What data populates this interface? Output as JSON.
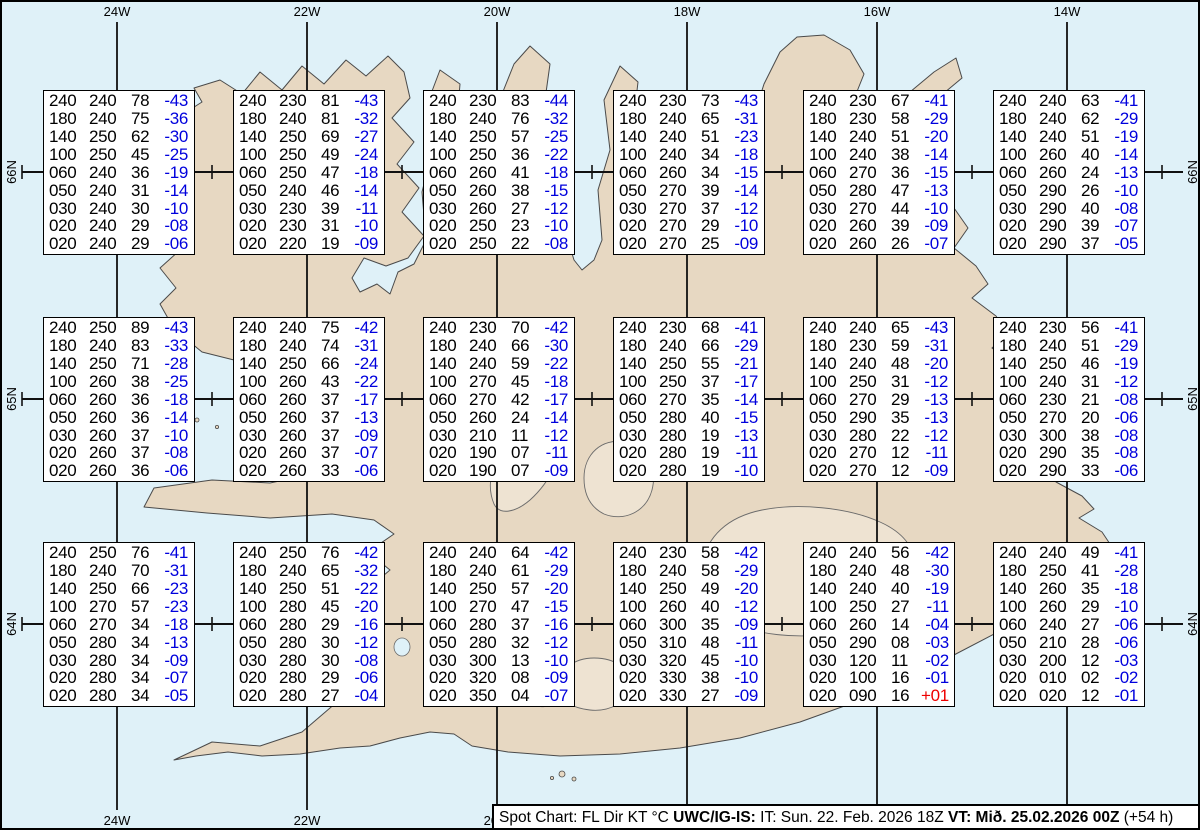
{
  "status_bar": {
    "prefix": "Spot Chart: FL Dir KT °C ",
    "source": "UWC/IG-IS:",
    "issued": " IT: Sun. 22. Feb. 2026 18Z ",
    "valid": "VT: Mið. 25.02.2026 00Z",
    "offset": " (+54 h)"
  },
  "grid": {
    "lon_labels_top": [
      "24W",
      "22W",
      "20W",
      "18W",
      "16W",
      "14W"
    ],
    "lon_labels_bottom": [
      "24W",
      "22W",
      "20W"
    ],
    "lat_labels_left": [
      "66N",
      "65N",
      "64N"
    ],
    "lat_labels_right": [
      "66N",
      "65N",
      "64N"
    ]
  },
  "colors": {
    "water": "#dff1f8",
    "land": "#e7d8c2",
    "coastline": "#4a4a4a",
    "grid_line": "#111111",
    "temp_blue": "#0000dd",
    "temp_red": "#ee0000"
  },
  "columns_meaning": [
    "FL",
    "Dir",
    "KT",
    "°C"
  ],
  "spots": [
    {
      "rows": [
        [
          "240",
          "240",
          "78",
          "-43"
        ],
        [
          "180",
          "240",
          "75",
          "-36"
        ],
        [
          "140",
          "250",
          "62",
          "-30"
        ],
        [
          "100",
          "250",
          "45",
          "-25"
        ],
        [
          "060",
          "240",
          "36",
          "-19"
        ],
        [
          "050",
          "240",
          "31",
          "-14"
        ],
        [
          "030",
          "240",
          "30",
          "-10"
        ],
        [
          "020",
          "240",
          "29",
          "-08"
        ],
        [
          "020",
          "240",
          "29",
          "-06"
        ]
      ]
    },
    {
      "rows": [
        [
          "240",
          "230",
          "81",
          "-43"
        ],
        [
          "180",
          "240",
          "81",
          "-32"
        ],
        [
          "140",
          "250",
          "69",
          "-27"
        ],
        [
          "100",
          "250",
          "49",
          "-24"
        ],
        [
          "060",
          "250",
          "47",
          "-18"
        ],
        [
          "050",
          "240",
          "46",
          "-14"
        ],
        [
          "030",
          "230",
          "39",
          "-11"
        ],
        [
          "020",
          "230",
          "31",
          "-10"
        ],
        [
          "020",
          "220",
          "19",
          "-09"
        ]
      ]
    },
    {
      "rows": [
        [
          "240",
          "230",
          "83",
          "-44"
        ],
        [
          "180",
          "240",
          "76",
          "-32"
        ],
        [
          "140",
          "250",
          "57",
          "-25"
        ],
        [
          "100",
          "250",
          "36",
          "-22"
        ],
        [
          "060",
          "260",
          "41",
          "-18"
        ],
        [
          "050",
          "260",
          "38",
          "-15"
        ],
        [
          "030",
          "260",
          "27",
          "-12"
        ],
        [
          "020",
          "250",
          "23",
          "-10"
        ],
        [
          "020",
          "250",
          "22",
          "-08"
        ]
      ]
    },
    {
      "rows": [
        [
          "240",
          "230",
          "73",
          "-43"
        ],
        [
          "180",
          "240",
          "65",
          "-31"
        ],
        [
          "140",
          "240",
          "51",
          "-23"
        ],
        [
          "100",
          "240",
          "34",
          "-18"
        ],
        [
          "060",
          "260",
          "34",
          "-15"
        ],
        [
          "050",
          "270",
          "39",
          "-14"
        ],
        [
          "030",
          "270",
          "37",
          "-12"
        ],
        [
          "020",
          "270",
          "29",
          "-10"
        ],
        [
          "020",
          "270",
          "25",
          "-09"
        ]
      ]
    },
    {
      "rows": [
        [
          "240",
          "230",
          "67",
          "-41"
        ],
        [
          "180",
          "230",
          "58",
          "-29"
        ],
        [
          "140",
          "240",
          "51",
          "-20"
        ],
        [
          "100",
          "240",
          "38",
          "-14"
        ],
        [
          "060",
          "270",
          "36",
          "-15"
        ],
        [
          "050",
          "280",
          "47",
          "-13"
        ],
        [
          "030",
          "270",
          "44",
          "-10"
        ],
        [
          "020",
          "260",
          "39",
          "-09"
        ],
        [
          "020",
          "260",
          "26",
          "-07"
        ]
      ]
    },
    {
      "rows": [
        [
          "240",
          "240",
          "63",
          "-41"
        ],
        [
          "180",
          "240",
          "62",
          "-29"
        ],
        [
          "140",
          "240",
          "51",
          "-19"
        ],
        [
          "100",
          "260",
          "40",
          "-14"
        ],
        [
          "060",
          "260",
          "24",
          "-13"
        ],
        [
          "050",
          "290",
          "26",
          "-10"
        ],
        [
          "030",
          "290",
          "40",
          "-08"
        ],
        [
          "020",
          "290",
          "39",
          "-07"
        ],
        [
          "020",
          "290",
          "37",
          "-05"
        ]
      ]
    },
    {
      "rows": [
        [
          "240",
          "250",
          "89",
          "-43"
        ],
        [
          "180",
          "240",
          "83",
          "-33"
        ],
        [
          "140",
          "250",
          "71",
          "-28"
        ],
        [
          "100",
          "260",
          "38",
          "-25"
        ],
        [
          "060",
          "260",
          "36",
          "-18"
        ],
        [
          "050",
          "260",
          "36",
          "-14"
        ],
        [
          "030",
          "260",
          "37",
          "-10"
        ],
        [
          "020",
          "260",
          "37",
          "-08"
        ],
        [
          "020",
          "260",
          "36",
          "-06"
        ]
      ]
    },
    {
      "rows": [
        [
          "240",
          "240",
          "75",
          "-42"
        ],
        [
          "180",
          "240",
          "74",
          "-31"
        ],
        [
          "140",
          "250",
          "66",
          "-24"
        ],
        [
          "100",
          "260",
          "43",
          "-22"
        ],
        [
          "060",
          "260",
          "37",
          "-17"
        ],
        [
          "050",
          "260",
          "37",
          "-13"
        ],
        [
          "030",
          "260",
          "37",
          "-09"
        ],
        [
          "020",
          "260",
          "37",
          "-07"
        ],
        [
          "020",
          "260",
          "33",
          "-06"
        ]
      ]
    },
    {
      "rows": [
        [
          "240",
          "230",
          "70",
          "-42"
        ],
        [
          "180",
          "240",
          "66",
          "-30"
        ],
        [
          "140",
          "240",
          "59",
          "-22"
        ],
        [
          "100",
          "270",
          "45",
          "-18"
        ],
        [
          "060",
          "270",
          "42",
          "-17"
        ],
        [
          "050",
          "260",
          "24",
          "-14"
        ],
        [
          "030",
          "210",
          "11",
          "-12"
        ],
        [
          "020",
          "190",
          "07",
          "-11"
        ],
        [
          "020",
          "190",
          "07",
          "-09"
        ]
      ]
    },
    {
      "rows": [
        [
          "240",
          "230",
          "68",
          "-41"
        ],
        [
          "180",
          "240",
          "66",
          "-29"
        ],
        [
          "140",
          "250",
          "55",
          "-21"
        ],
        [
          "100",
          "250",
          "37",
          "-17"
        ],
        [
          "060",
          "270",
          "35",
          "-14"
        ],
        [
          "050",
          "280",
          "40",
          "-15"
        ],
        [
          "030",
          "280",
          "19",
          "-13"
        ],
        [
          "020",
          "280",
          "19",
          "-11"
        ],
        [
          "020",
          "280",
          "19",
          "-10"
        ]
      ]
    },
    {
      "rows": [
        [
          "240",
          "240",
          "65",
          "-43"
        ],
        [
          "180",
          "230",
          "59",
          "-31"
        ],
        [
          "140",
          "240",
          "48",
          "-20"
        ],
        [
          "100",
          "250",
          "31",
          "-12"
        ],
        [
          "060",
          "270",
          "29",
          "-13"
        ],
        [
          "050",
          "290",
          "35",
          "-13"
        ],
        [
          "030",
          "280",
          "22",
          "-12"
        ],
        [
          "020",
          "270",
          "12",
          "-11"
        ],
        [
          "020",
          "270",
          "12",
          "-09"
        ]
      ]
    },
    {
      "rows": [
        [
          "240",
          "230",
          "56",
          "-41"
        ],
        [
          "180",
          "240",
          "51",
          "-29"
        ],
        [
          "140",
          "250",
          "46",
          "-19"
        ],
        [
          "100",
          "240",
          "31",
          "-12"
        ],
        [
          "060",
          "230",
          "21",
          "-08"
        ],
        [
          "050",
          "270",
          "20",
          "-06"
        ],
        [
          "030",
          "300",
          "38",
          "-08"
        ],
        [
          "020",
          "290",
          "35",
          "-08"
        ],
        [
          "020",
          "290",
          "33",
          "-06"
        ]
      ]
    },
    {
      "rows": [
        [
          "240",
          "250",
          "76",
          "-41"
        ],
        [
          "180",
          "240",
          "70",
          "-31"
        ],
        [
          "140",
          "250",
          "66",
          "-23"
        ],
        [
          "100",
          "270",
          "57",
          "-23"
        ],
        [
          "060",
          "270",
          "34",
          "-18"
        ],
        [
          "050",
          "280",
          "34",
          "-13"
        ],
        [
          "030",
          "280",
          "34",
          "-09"
        ],
        [
          "020",
          "280",
          "34",
          "-07"
        ],
        [
          "020",
          "280",
          "34",
          "-05"
        ]
      ]
    },
    {
      "rows": [
        [
          "240",
          "250",
          "76",
          "-42"
        ],
        [
          "180",
          "240",
          "65",
          "-32"
        ],
        [
          "140",
          "250",
          "51",
          "-22"
        ],
        [
          "100",
          "280",
          "45",
          "-20"
        ],
        [
          "060",
          "280",
          "29",
          "-16"
        ],
        [
          "050",
          "280",
          "30",
          "-12"
        ],
        [
          "030",
          "280",
          "30",
          "-08"
        ],
        [
          "020",
          "280",
          "29",
          "-06"
        ],
        [
          "020",
          "280",
          "27",
          "-04"
        ]
      ]
    },
    {
      "rows": [
        [
          "240",
          "240",
          "64",
          "-42"
        ],
        [
          "180",
          "240",
          "61",
          "-29"
        ],
        [
          "140",
          "250",
          "57",
          "-20"
        ],
        [
          "100",
          "270",
          "47",
          "-15"
        ],
        [
          "060",
          "280",
          "37",
          "-16"
        ],
        [
          "050",
          "280",
          "32",
          "-12"
        ],
        [
          "030",
          "300",
          "13",
          "-10"
        ],
        [
          "020",
          "320",
          "08",
          "-09"
        ],
        [
          "020",
          "350",
          "04",
          "-07"
        ]
      ]
    },
    {
      "rows": [
        [
          "240",
          "230",
          "58",
          "-42"
        ],
        [
          "180",
          "240",
          "58",
          "-29"
        ],
        [
          "140",
          "250",
          "49",
          "-20"
        ],
        [
          "100",
          "260",
          "40",
          "-12"
        ],
        [
          "060",
          "300",
          "35",
          "-09"
        ],
        [
          "050",
          "310",
          "48",
          "-11"
        ],
        [
          "030",
          "320",
          "45",
          "-10"
        ],
        [
          "020",
          "330",
          "38",
          "-10"
        ],
        [
          "020",
          "330",
          "27",
          "-09"
        ]
      ]
    },
    {
      "rows": [
        [
          "240",
          "240",
          "56",
          "-42"
        ],
        [
          "180",
          "240",
          "48",
          "-30"
        ],
        [
          "140",
          "240",
          "40",
          "-19"
        ],
        [
          "100",
          "250",
          "27",
          "-11"
        ],
        [
          "060",
          "260",
          "14",
          "-04"
        ],
        [
          "050",
          "290",
          "08",
          "-03"
        ],
        [
          "030",
          "120",
          "11",
          "-02"
        ],
        [
          "020",
          "100",
          "16",
          "-01"
        ],
        [
          "020",
          "090",
          "16",
          "+01"
        ]
      ]
    },
    {
      "rows": [
        [
          "240",
          "240",
          "49",
          "-41"
        ],
        [
          "180",
          "250",
          "41",
          "-28"
        ],
        [
          "140",
          "260",
          "35",
          "-18"
        ],
        [
          "100",
          "260",
          "29",
          "-10"
        ],
        [
          "060",
          "240",
          "27",
          "-06"
        ],
        [
          "050",
          "210",
          "28",
          "-06"
        ],
        [
          "030",
          "200",
          "12",
          "-03"
        ],
        [
          "020",
          "010",
          "02",
          "-02"
        ],
        [
          "020",
          "020",
          "12",
          "-01"
        ]
      ]
    }
  ]
}
